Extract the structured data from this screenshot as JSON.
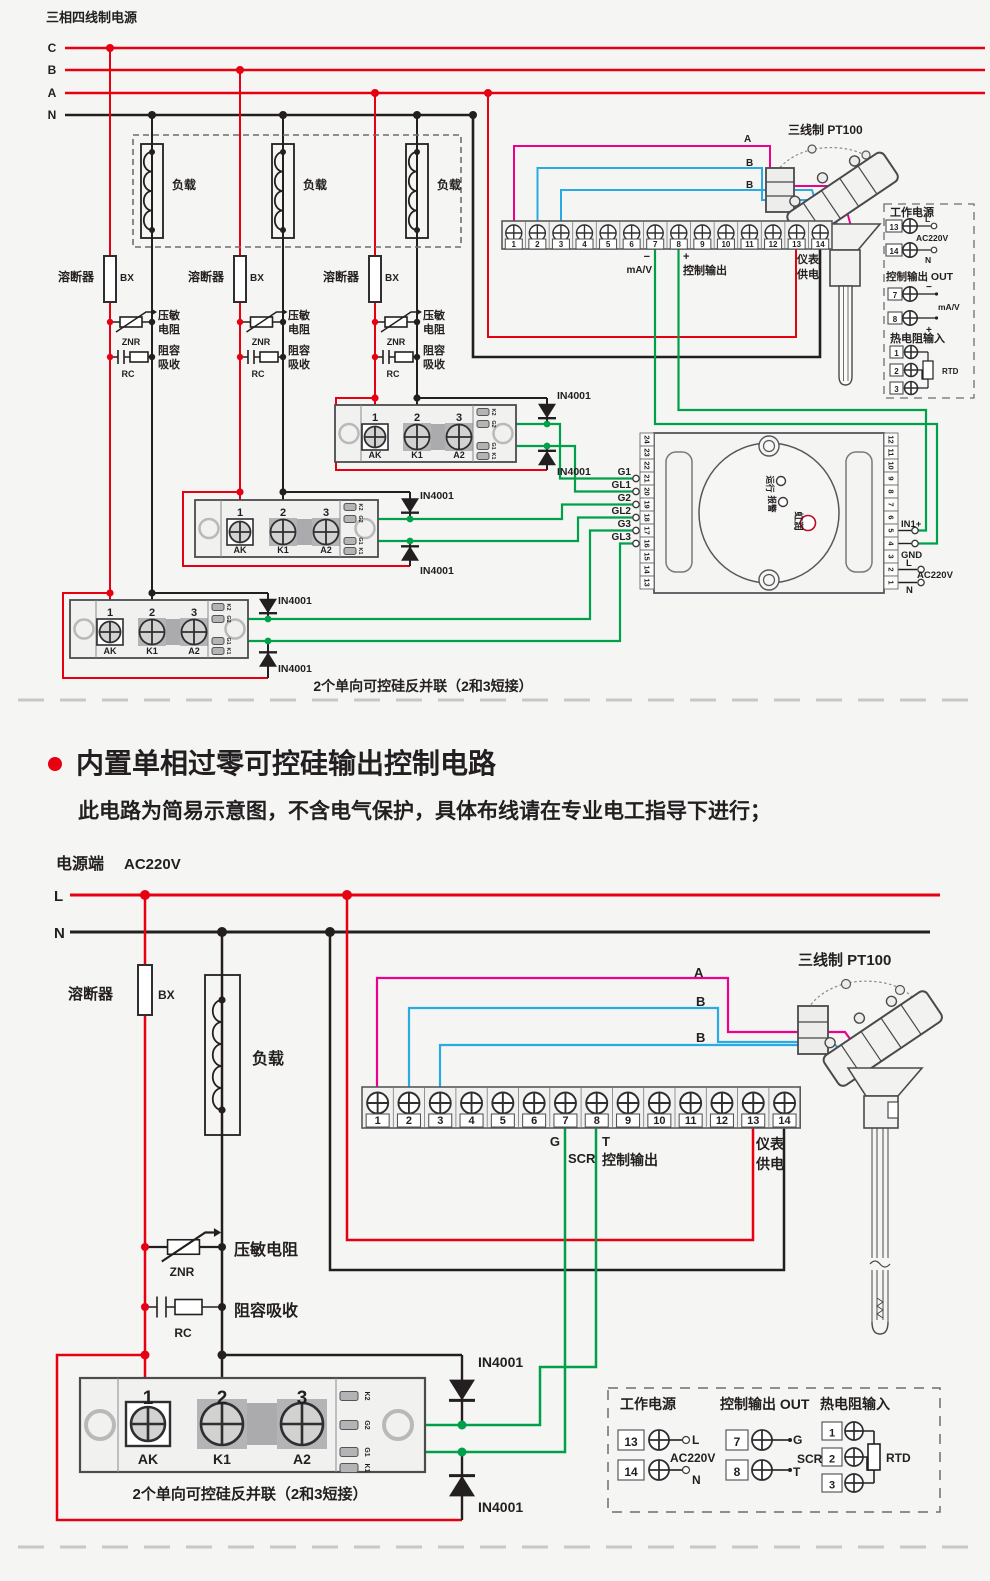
{
  "colors": {
    "red": "#e60012",
    "black": "#231f20",
    "green": "#00a04b",
    "blue": "#29abe2",
    "magenta": "#ec008c",
    "gray": "#c8c8c8",
    "bg": "#f5f5f3"
  },
  "top": {
    "title": "三相四线制电源",
    "phases": [
      "C",
      "B",
      "A",
      "N"
    ],
    "load": "负载",
    "fuse": "溶断器",
    "fuse_code": "BX",
    "znr_code": "ZNR",
    "znr_l1": "压敏",
    "znr_l2": "电阻",
    "rc_code": "RC",
    "rc_l1": "阻容",
    "rc_l2": "吸收",
    "diode": "IN4001",
    "caption": "2个单向可控硅反并联（2和3短接）",
    "sensor": "三线制 PT100",
    "wires": [
      "A",
      "B",
      "B"
    ],
    "strip": {
      "numbers": [
        "1",
        "2",
        "3",
        "4",
        "5",
        "6",
        "7",
        "8",
        "9",
        "10",
        "11",
        "12",
        "13",
        "14"
      ],
      "minus": "−",
      "mav": "mA/V",
      "plus": "+",
      "ctrl": "控制输出",
      "meter1": "仪表",
      "meter2": "供电"
    },
    "module": {
      "nums": [
        "1",
        "2",
        "3"
      ],
      "labels": [
        "AK",
        "K1",
        "A2"
      ],
      "side": [
        "K2",
        "G2",
        "G1",
        "K1"
      ]
    },
    "gates": [
      "G1",
      "GL1",
      "G2",
      "GL2",
      "G3",
      "GL3"
    ],
    "controller": {
      "left": [
        "24",
        "23",
        "22",
        "21",
        "20",
        "19",
        "18",
        "17",
        "16",
        "15",
        "14",
        "13"
      ],
      "right": [
        "12",
        "11",
        "10",
        "9",
        "8",
        "7",
        "6",
        "5",
        "4",
        "3",
        "2",
        "1"
      ],
      "run": "运行",
      "alarm": "报警",
      "brand": "虹润",
      "in1": "IN1+",
      "gnd": "GND",
      "l": "L",
      "ac": "AC220V",
      "n": "N"
    },
    "legend": {
      "t1": "工作电源",
      "r13": "13",
      "r14": "14",
      "l": "L",
      "n": "N",
      "ac": "AC220V",
      "t2": "控制输出 OUT",
      "r7": "7",
      "r8": "8",
      "minus": "−",
      "plus": "+",
      "mav": "mA/V",
      "t3": "热电阻输入",
      "r1": "1",
      "r2": "2",
      "r3": "3",
      "rtd": "RTD"
    }
  },
  "bottom": {
    "bullet_title": "内置单相过零可控硅输出控制电路",
    "subtitle": "此电路为简易示意图，不含电气保护，具体布线请在专业电工指导下进行；",
    "supply": "电源端",
    "voltage": "AC220V",
    "l": "L",
    "n": "N",
    "fuse": "溶断器",
    "fuse_code": "BX",
    "load": "负载",
    "znr_code": "ZNR",
    "znr": "压敏电阻",
    "rc_code": "RC",
    "rc": "阻容吸收",
    "diode": "IN4001",
    "caption": "2个单向可控硅反并联（2和3短接）",
    "sensor": "三线制 PT100",
    "wires": [
      "A",
      "B",
      "B"
    ],
    "strip": {
      "numbers": [
        "1",
        "2",
        "3",
        "4",
        "5",
        "6",
        "7",
        "8",
        "9",
        "10",
        "11",
        "12",
        "13",
        "14"
      ],
      "g": "G",
      "scr": "SCR",
      "t": "T",
      "ctrl": "控制输出",
      "meter1": "仪表",
      "meter2": "供电"
    },
    "module": {
      "nums": [
        "1",
        "2",
        "3"
      ],
      "labels": [
        "AK",
        "K1",
        "A2"
      ],
      "side": [
        "K2",
        "G2",
        "G1",
        "K1"
      ]
    },
    "legend": {
      "t1": "工作电源",
      "r13": "13",
      "r14": "14",
      "l": "L",
      "n": "N",
      "ac": "AC220V",
      "t2": "控制输出 OUT",
      "r7": "7",
      "r8": "8",
      "g": "G",
      "t": "T",
      "scr": "SCR",
      "t3": "热电阻输入",
      "r1": "1",
      "r2": "2",
      "r3": "3",
      "rtd": "RTD"
    }
  }
}
